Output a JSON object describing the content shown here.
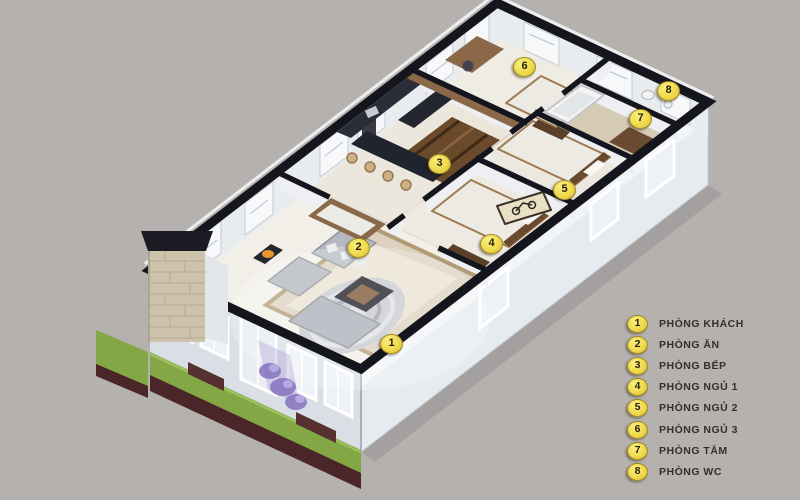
{
  "scene": {
    "description": "3D isometric cutaway floor plan of an apartment with eight numbered rooms",
    "background": "#b5b1ae"
  },
  "legend": {
    "items": [
      {
        "number": "1",
        "label": "PHÒNG KHÁCH"
      },
      {
        "number": "2",
        "label": "PHÒNG ĂN"
      },
      {
        "number": "3",
        "label": "PHÒNG BẾP"
      },
      {
        "number": "4",
        "label": "PHÒNG NGỦ 1"
      },
      {
        "number": "5",
        "label": "PHÒNG NGỦ 2"
      },
      {
        "number": "6",
        "label": "PHÒNG NGỦ 3"
      },
      {
        "number": "7",
        "label": "PHÒNG TẮM"
      },
      {
        "number": "8",
        "label": "PHÒNG WC"
      }
    ]
  },
  "markers": [
    {
      "number": "1",
      "x": 390,
      "y": 343
    },
    {
      "number": "2",
      "x": 357,
      "y": 247
    },
    {
      "number": "3",
      "x": 438,
      "y": 163
    },
    {
      "number": "4",
      "x": 490,
      "y": 243
    },
    {
      "number": "5",
      "x": 563,
      "y": 189
    },
    {
      "number": "6",
      "x": 523,
      "y": 66
    },
    {
      "number": "7",
      "x": 639,
      "y": 118
    },
    {
      "number": "8",
      "x": 667,
      "y": 90
    }
  ],
  "colors": {
    "badge": "#efda4e",
    "badge_text": "#2a1d06",
    "legend_text": "#33302b",
    "wall_top": "#15151d",
    "wall_face": "#e4e9ed",
    "floor": "#efece4",
    "bath_floor": "#d6cbb6",
    "grass": "#84a746",
    "mulch": "#4b2629",
    "flowers": "#8b77c2",
    "wood": "#8a6848",
    "counter_dark": "#20242f"
  }
}
